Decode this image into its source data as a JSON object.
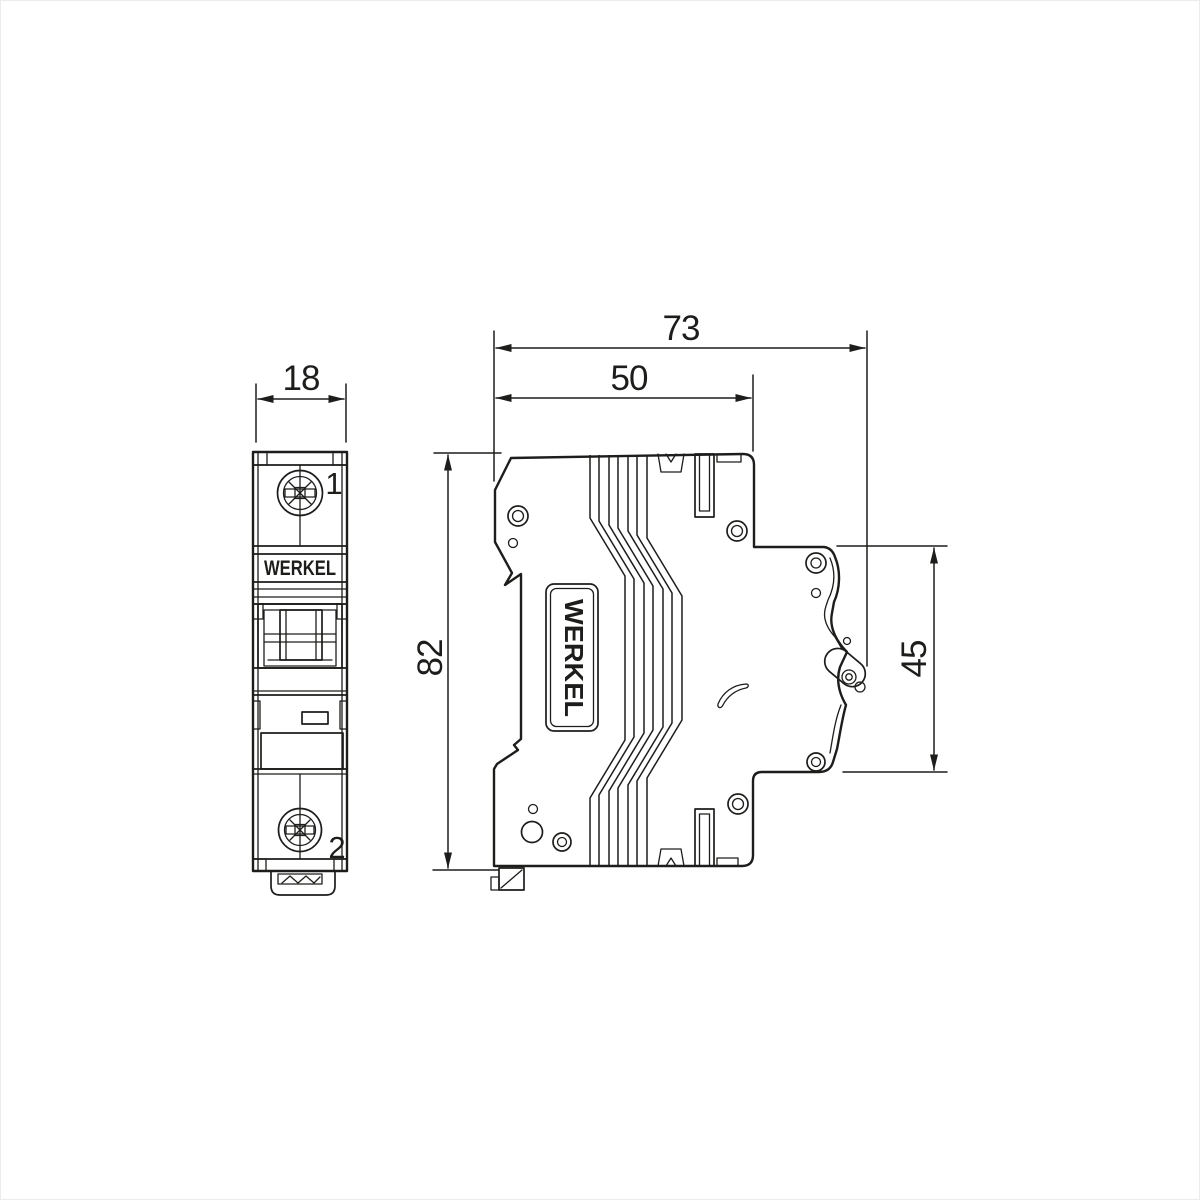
{
  "drawing": {
    "type": "dimensional-drawing",
    "brand": "WERKEL",
    "line_color": "#1d1d1b",
    "background": "#ffffff",
    "front_view": {
      "brand_label": "WERKEL",
      "terminal_top_label": "1",
      "terminal_bottom_label": "2",
      "width_dim": "18"
    },
    "side_view": {
      "brand_label": "WERKEL",
      "overall_depth_dim": "73",
      "upper_depth_dim": "50",
      "height_dim": "82",
      "din_face_height_dim": "45"
    }
  }
}
